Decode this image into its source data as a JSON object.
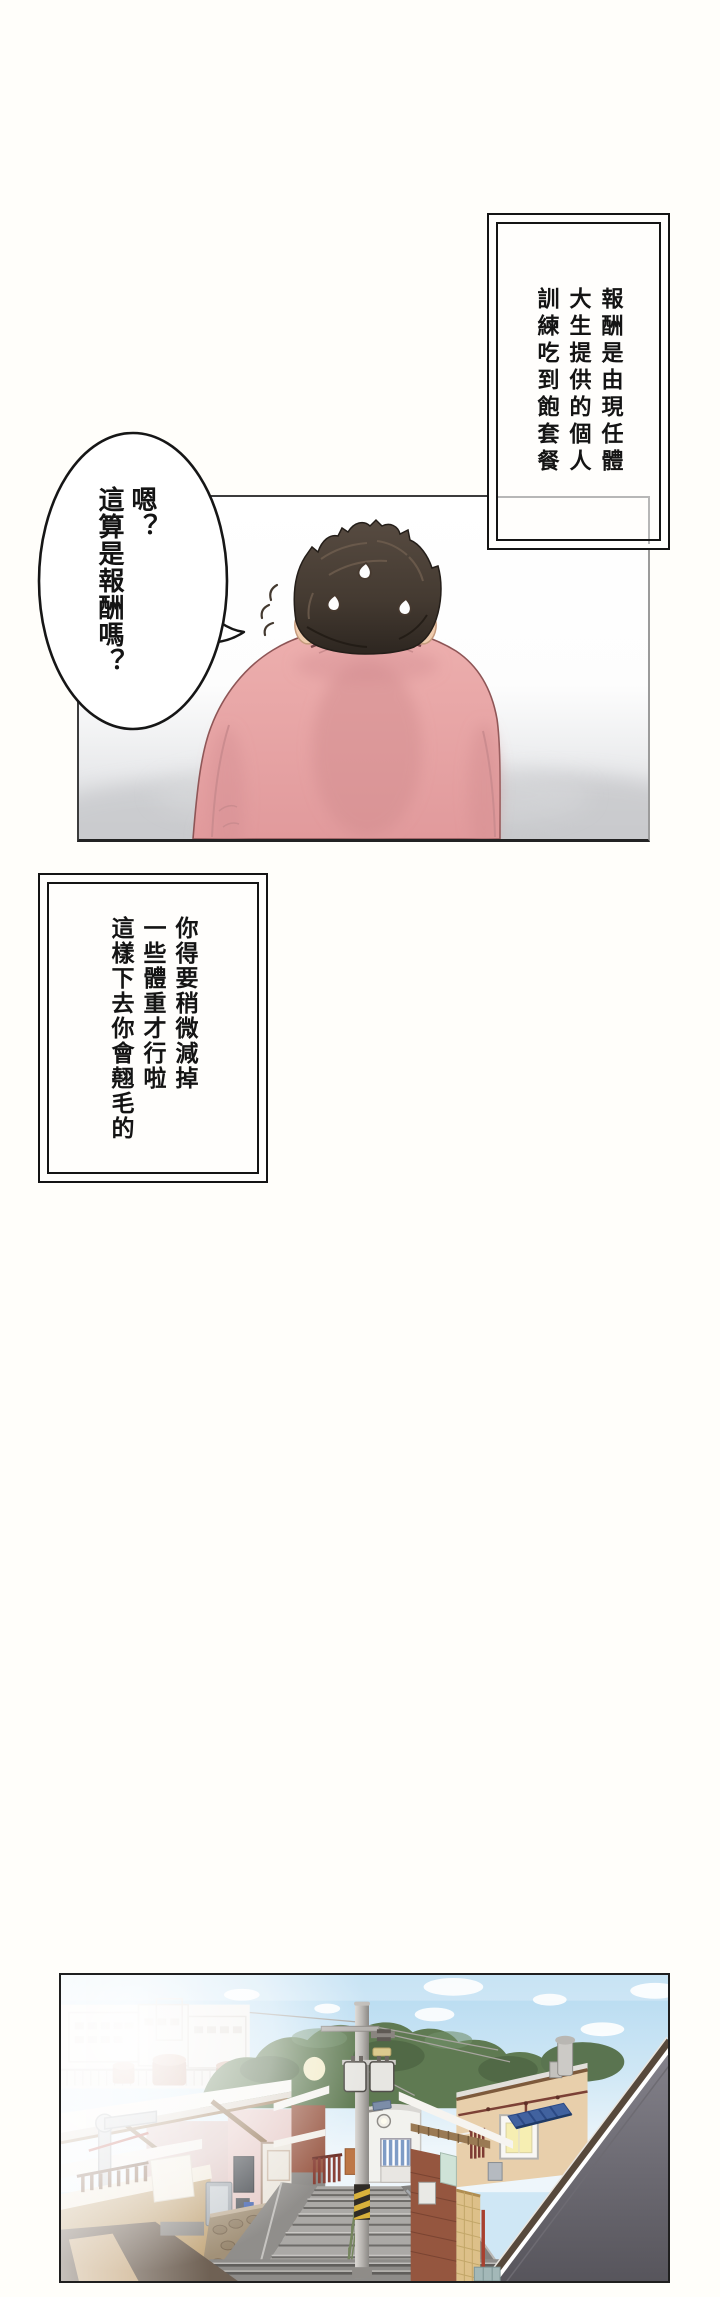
{
  "comic": {
    "caption_top_right": {
      "lines": [
        "報酬是由現任體",
        "大生提供的個人",
        "訓練吃到飽套餐"
      ]
    },
    "speech_bubble": {
      "lines": [
        "嗯？",
        "這算是報酬嗎？"
      ]
    },
    "caption_left": {
      "lines": [
        "你得要稍微減掉",
        "一些體重才行啦",
        "這樣下去你會翹毛的"
      ]
    }
  },
  "colors": {
    "page_background": "#fffefa",
    "shirt_pink": "#e8a4a4",
    "hair_brown": "#3d332b",
    "panel_fog_gray": "#d3d4d7",
    "sky_blue": "#bfe2f5",
    "tree_green": "#5f7a52",
    "awning_blue": "#41629f",
    "warning_yellow": "#d9b23c",
    "brick_red": "#95563f",
    "tan_wall": "#c4a87d"
  }
}
